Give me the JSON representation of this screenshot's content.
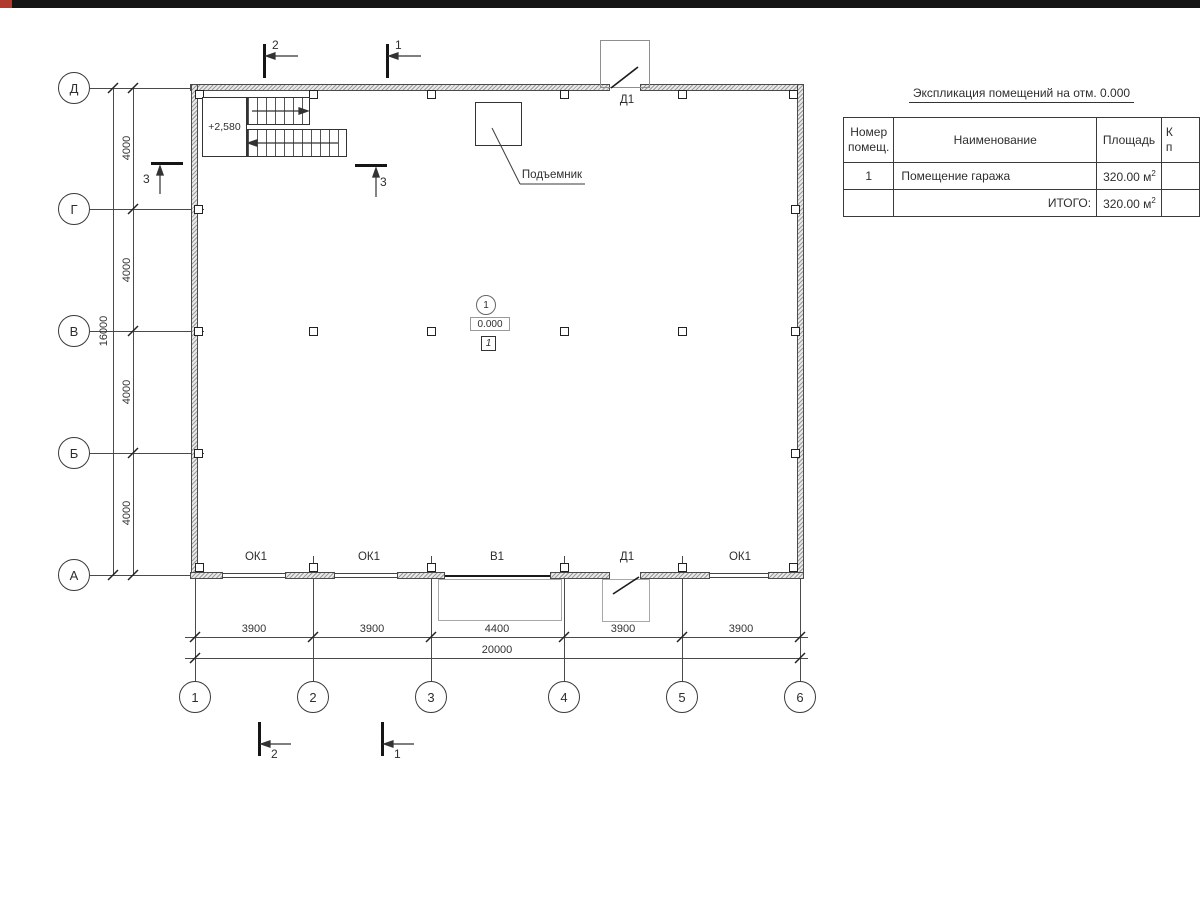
{
  "chrome": {
    "top_bar_color": "#151515",
    "accent_red": "#b03a2e"
  },
  "table": {
    "title": "Экспликация помещений на отм. 0.000",
    "header_num_line1": "Номер",
    "header_num_line2": "помещ.",
    "header_name": "Наименование",
    "header_area": "Площадь",
    "header_cut_line1": "К",
    "header_cut_line2": "п",
    "row1": {
      "num": "1",
      "name": "Помещение гаража",
      "area": "320.00 м",
      "area_sup": "2"
    },
    "total": {
      "label": "ИТОГО:",
      "area": "320.00 м",
      "area_sup": "2"
    }
  },
  "axes": {
    "rows": [
      "Д",
      "Г",
      "В",
      "Б",
      "А"
    ],
    "cols": [
      "1",
      "2",
      "3",
      "4",
      "5",
      "6"
    ]
  },
  "dims": {
    "vertical_segments": [
      "4000",
      "4000",
      "4000",
      "4000"
    ],
    "vertical_total": "16000",
    "horizontal_segments": [
      "3900",
      "3900",
      "4400",
      "3900",
      "3900"
    ],
    "horizontal_total": "20000"
  },
  "sections": {
    "s1": "1",
    "s2": "2",
    "s3": "3"
  },
  "plan_labels": {
    "stair_level": "+2,580",
    "lift": "Подъемник",
    "door_top": "Д1",
    "door_bottom": "Д1",
    "gate_bottom": "В1",
    "windows": [
      "ОК1",
      "ОК1",
      "ОК1"
    ],
    "room_number": "1",
    "level_mark": "0.000",
    "floor_mark": "1"
  }
}
